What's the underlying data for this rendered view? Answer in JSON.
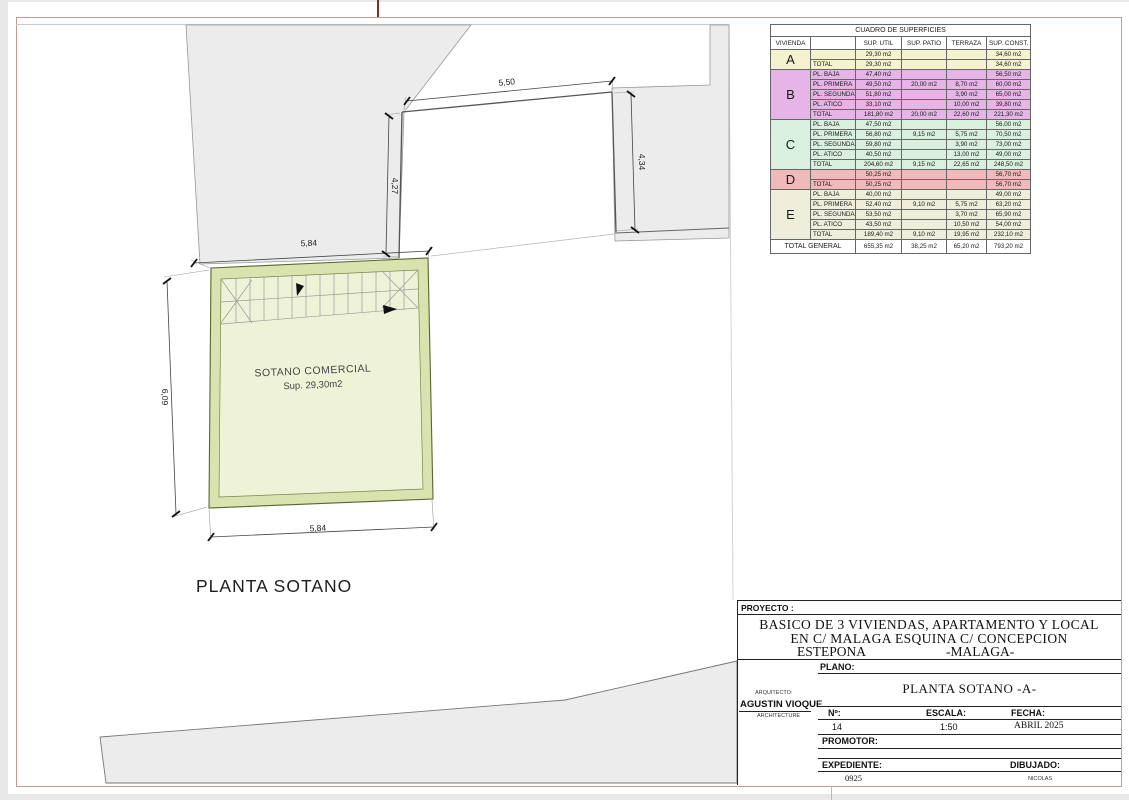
{
  "plan": {
    "caption": "PLANTA SOTANO",
    "room": {
      "name": "SOTANO COMERCIAL",
      "area": "Sup. 29,30m2"
    },
    "dims": {
      "notch_width": "5,50",
      "notch_left_height": "4,27",
      "notch_right_height": "4,34",
      "top_width": "5,84",
      "left_height": "6,09",
      "bottom_width": "5,84"
    }
  },
  "surfaces_table": {
    "title": "CUADRO DE SUPERFICIES",
    "columns": [
      "VIVIENDA",
      "",
      "SUP. UTIL",
      "SUP. PATIO",
      "TERRAZA",
      "SUP. CONST."
    ],
    "sections": [
      {
        "letter": "A",
        "color": "#f5f2d0",
        "rows": [
          {
            "cells": [
              "",
              "29,30 m2",
              "",
              "",
              "34,60 m2"
            ]
          },
          {
            "cells": [
              "TOTAL",
              "29,30 m2",
              "",
              "",
              "34,60 m2"
            ]
          }
        ]
      },
      {
        "letter": "B",
        "color": "#e6b4e6",
        "rows": [
          {
            "cells": [
              "PL. BAJA",
              "47,40 m2",
              "",
              "",
              "56,50 m2"
            ]
          },
          {
            "cells": [
              "PL. PRIMERA",
              "49,50 m2",
              "20,00 m2",
              "8,70 m2",
              "60,00 m2"
            ]
          },
          {
            "cells": [
              "PL. SEGUNDA",
              "51,80 m2",
              "",
              "3,90 m2",
              "65,00 m2"
            ]
          },
          {
            "cells": [
              "PL. ATICO",
              "33,10 m2",
              "",
              "10,00 m2",
              "39,80 m2"
            ]
          },
          {
            "cells": [
              "TOTAL",
              "181,80 m2",
              "20,00 m2",
              "22,60 m2",
              "221,30 m2"
            ]
          }
        ]
      },
      {
        "letter": "C",
        "color": "#d8f0dd",
        "rows": [
          {
            "cells": [
              "PL. BAJA",
              "47,50 m2",
              "",
              "",
              "56,00 m2"
            ]
          },
          {
            "cells": [
              "PL. PRIMERA",
              "56,80 m2",
              "9,15 m2",
              "5,75 m2",
              "70,50 m2"
            ]
          },
          {
            "cells": [
              "PL. SEGUNDA",
              "59,80 m2",
              "",
              "3,90 m2",
              "73,00 m2"
            ]
          },
          {
            "cells": [
              "PL. ATICO",
              "40,50 m2",
              "",
              "13,00 m2",
              "49,00 m2"
            ]
          },
          {
            "cells": [
              "TOTAL",
              "204,60 m2",
              "9,15 m2",
              "22,65 m2",
              "248,50 m2"
            ]
          }
        ]
      },
      {
        "letter": "D",
        "color": "#f1baba",
        "rows": [
          {
            "cells": [
              "",
              "50,25 m2",
              "",
              "",
              "56,70 m2"
            ]
          },
          {
            "cells": [
              "TOTAL",
              "50,25 m2",
              "",
              "",
              "56,70 m2"
            ]
          }
        ]
      },
      {
        "letter": "E",
        "color": "#eeeedb",
        "rows": [
          {
            "cells": [
              "PL. BAJA",
              "40,00 m2",
              "",
              "",
              "49,00 m2"
            ]
          },
          {
            "cells": [
              "PL. PRIMERA",
              "52,40 m2",
              "9,10 m2",
              "5,75 m2",
              "63,20 m2"
            ]
          },
          {
            "cells": [
              "PL. SEGUNDA",
              "53,50 m2",
              "",
              "3,70 m2",
              "65,90 m2"
            ]
          },
          {
            "cells": [
              "PL. ATICO",
              "43,50 m2",
              "",
              "10,50 m2",
              "54,00 m2"
            ]
          },
          {
            "cells": [
              "TOTAL",
              "189,40 m2",
              "9,10 m2",
              "19,95 m2",
              "232,10 m2"
            ]
          }
        ]
      }
    ],
    "total_general": {
      "label": "TOTAL GENERAL",
      "util": "655,35 m2",
      "patio": "38,25 m2",
      "terraza": "65,20 m2",
      "const": "793,20 m2"
    }
  },
  "title_block": {
    "proyecto_label": "PROYECTO :",
    "project_lines": [
      "BASICO DE 3 VIVIENDAS, APARTAMENTO Y LOCAL",
      "EN  C/ MALAGA ESQUINA C/ CONCEPCION"
    ],
    "project_line3_left": "ESTEPONA",
    "project_line3_right": "-MALAGA-",
    "plano_label": "PLANO:",
    "plano_value": "PLANTA  SOTANO -A-",
    "arquitecto_label": "ARQUITECTO:",
    "arquitecto_name": "AGUSTIN VIOQUE",
    "arquitecto_sub": "ARCHITECTURE",
    "numero_label": "Nº:",
    "numero_value": "14",
    "escala_label": "ESCALA:",
    "escala_value": "1:50",
    "fecha_label": "FECHA:",
    "fecha_value": "ABRIL 2025",
    "promotor_label": "PROMOTOR:",
    "expediente_label": "EXPEDIENTE:",
    "expediente_value": "0925",
    "dibujado_label": "DIBUJADO:",
    "dibujado_value": "NICOLAS"
  },
  "colors": {
    "frame": "#c49a96",
    "neighbor_fill": "#ececec",
    "room_wall_fill": "#d8e3af",
    "room_floor_fill": "#eef3d8"
  }
}
